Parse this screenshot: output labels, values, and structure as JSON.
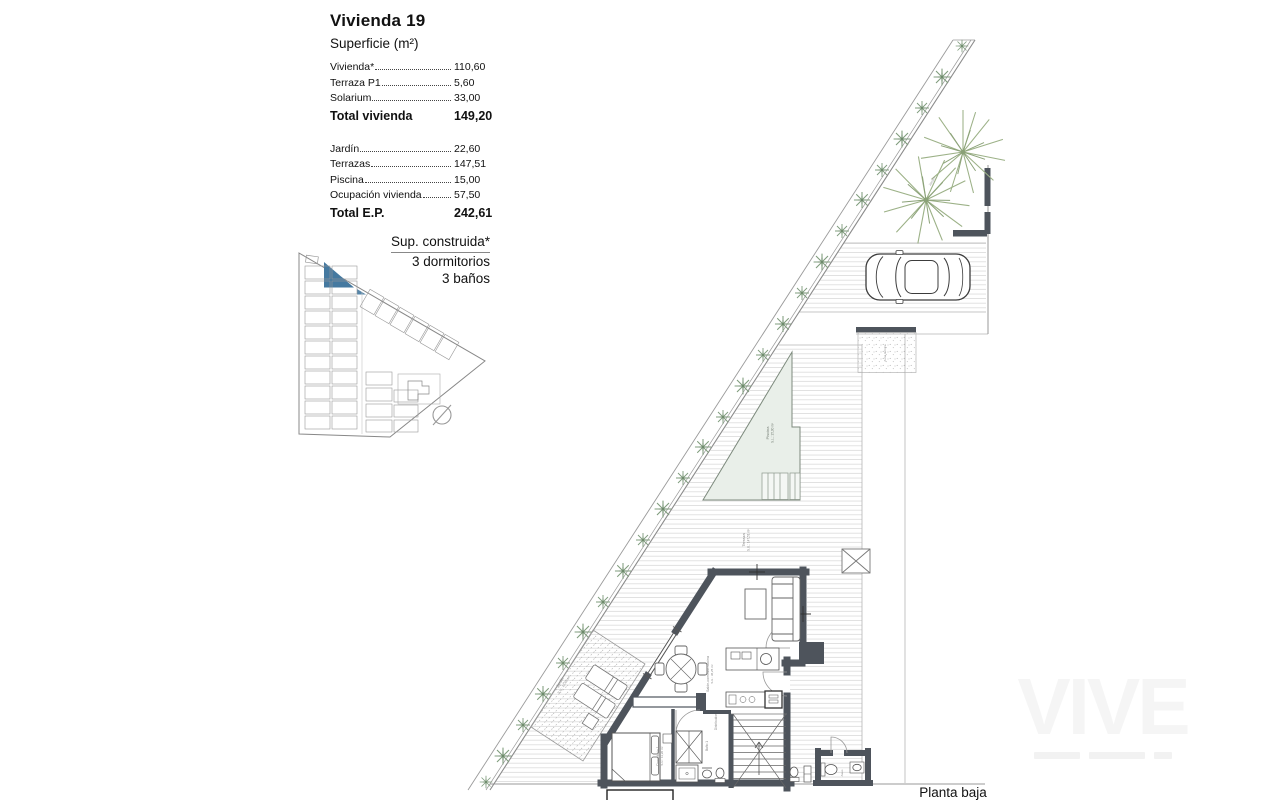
{
  "panel": {
    "title": "Vivienda 19",
    "subtitle": "Superficie (m²)",
    "group1": {
      "rows": [
        {
          "label": "Vivienda*",
          "value": "110,60"
        },
        {
          "label": "Terraza P1",
          "value": "5,60"
        },
        {
          "label": "Solarium",
          "value": "33,00"
        }
      ],
      "total": {
        "label": "Total vivienda",
        "value": "149,20"
      }
    },
    "group2": {
      "rows": [
        {
          "label": "Jardín",
          "value": "22,60"
        },
        {
          "label": "Terrazas",
          "value": "147,51"
        },
        {
          "label": "Piscina",
          "value": "15,00"
        },
        {
          "label": "Ocupación vivienda",
          "value": "57,50"
        }
      ],
      "total": {
        "label": "Total E.P.",
        "value": "242,61"
      }
    }
  },
  "built": {
    "title": "Sup. construida*",
    "bedrooms": "3 dormitorios",
    "bathrooms": "3 baños"
  },
  "plan_labels": {
    "pool": "Piscina",
    "pool_area": "S.L.: 15,00 m²",
    "terrace": "Terraza",
    "terrace_area": "S.U.: 147,51 m²",
    "garden": "Jardín",
    "garden_area": "S.U.: 22,60 m²",
    "living": "Salón-comedor-cocina",
    "living_area": "S.U.: 38,25 m²",
    "bedroom": "Dormitorio 1",
    "bedroom_area": "S.U.: 11,20 m²",
    "bath": "Baño 1",
    "hall": "Distribuidor",
    "aseo": "Aseo",
    "tech": "Zona técnica",
    "side_garden": "Jardín"
  },
  "footer": {
    "floor_label": "Planta baja"
  },
  "watermark": {
    "text": "VIVE"
  },
  "colors": {
    "highlight_blue": "#4579a0",
    "wall": "#4e545c",
    "pool_fill": "#e9efe9",
    "greenery": "#8aa387",
    "deck_line": "#d8d8d8"
  }
}
